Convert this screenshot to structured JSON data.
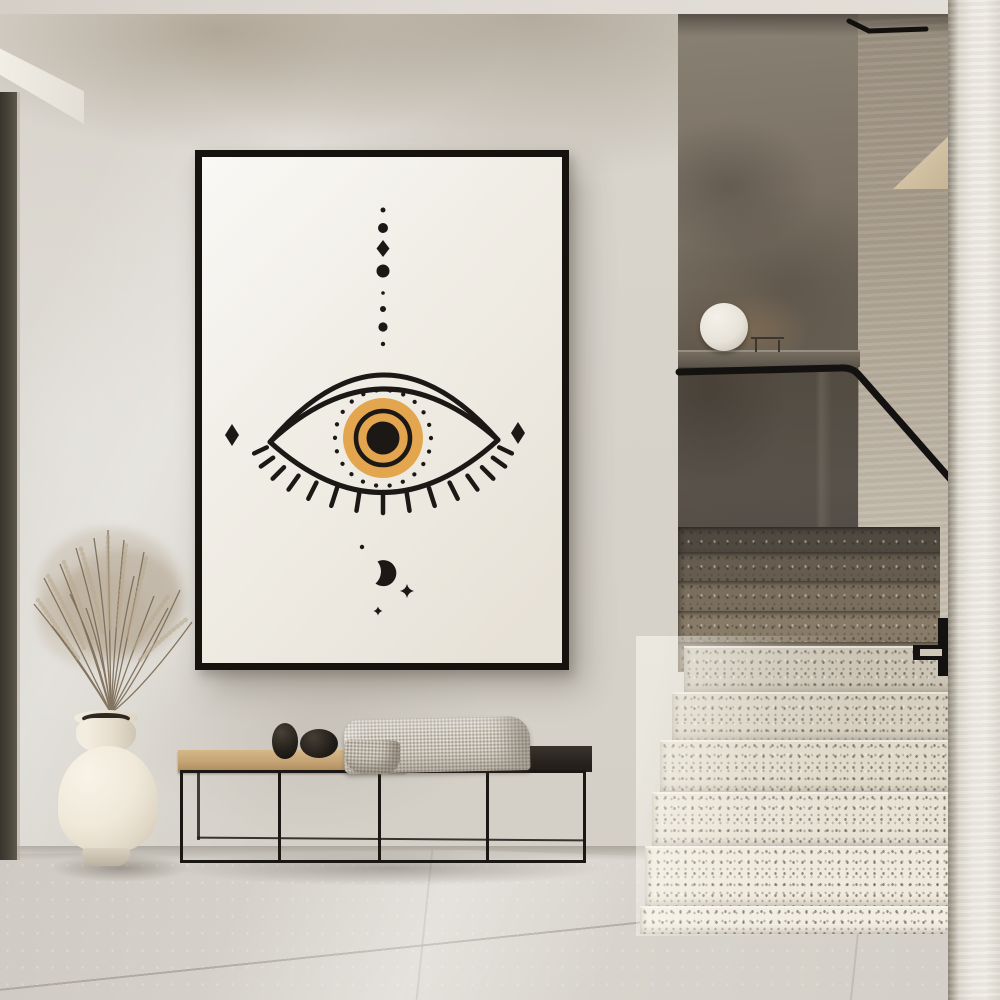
{
  "meta": {
    "label": "Minimalist hallway interior with staircase and framed evil-eye art print",
    "width_px": 1000,
    "height_px": 1000
  },
  "poster": {
    "label": "Framed evil-eye art print",
    "paper_color": "#F0EDE6",
    "ink_color": "#1B1816",
    "accent_color": "#E3A64F",
    "frame_color": "#16130F",
    "symbols": [
      "column of eight dots with one diamond",
      "double-lidded eye with lashes",
      "dotted halo around iris",
      "amber iris with black ring",
      "black pupil",
      "left side diamond",
      "right side diamond",
      "crescent moon",
      "four-point sparkle",
      "small sparkle"
    ]
  },
  "objects": {
    "ceiling": {
      "label": "Ceiling band",
      "color": "#DEDAD3"
    },
    "wall": {
      "label": "Limewash plaster wall",
      "color": "#D7D3CB"
    },
    "soffit": {
      "label": "White soffit above doorway",
      "color": "#F2EFE7"
    },
    "door_frame": {
      "label": "Dark door-frame edge at left",
      "color": "#4A463C"
    },
    "stair_opening": {
      "label": "Stairwell opening",
      "back_wall_color": "#6E655B"
    },
    "ledge": {
      "label": "Landing parapet ledge",
      "color": "#5B544A"
    },
    "lamp": {
      "label": "White sphere lamp on ledge",
      "color": "#ECE8E0"
    },
    "lamp_stand": {
      "label": "Small wire stand beside lamp",
      "color": "#3C362E"
    },
    "handrail": {
      "label": "Black metal handrail",
      "color": "#141210"
    },
    "upper_steps": {
      "label": "Terrazzo steps in shadow",
      "color": "#8B7E6B"
    },
    "lower_steps": {
      "label": "Terrazzo steps in light",
      "color": "#E8E2D5"
    },
    "newel_bracket": {
      "label": "Black stair rail bracket",
      "color": "#141210"
    },
    "stair_wedge": {
      "label": "Upper flight stringer wedge",
      "color": "#D8C8AB"
    },
    "right_pillar": {
      "label": "Foreground wall edge",
      "color": "#EAE7E0"
    },
    "bench": {
      "label": "Low bench with black steel frame",
      "wood_color": "#C7A878",
      "dark_top_color": "#2C2823"
    },
    "stones": {
      "label": "Two black pebble objects",
      "color": "#1D1A16"
    },
    "blanket": {
      "label": "Woven throw blanket",
      "color": "#CBC5B9"
    },
    "vase": {
      "label": "Cream ceramic vase",
      "color": "#EDE7DA"
    },
    "grass": {
      "label": "Dried pampas grass",
      "color": "#A8977E"
    },
    "floor": {
      "label": "Large-format stone tile floor",
      "color": "#D5D1CA"
    }
  }
}
